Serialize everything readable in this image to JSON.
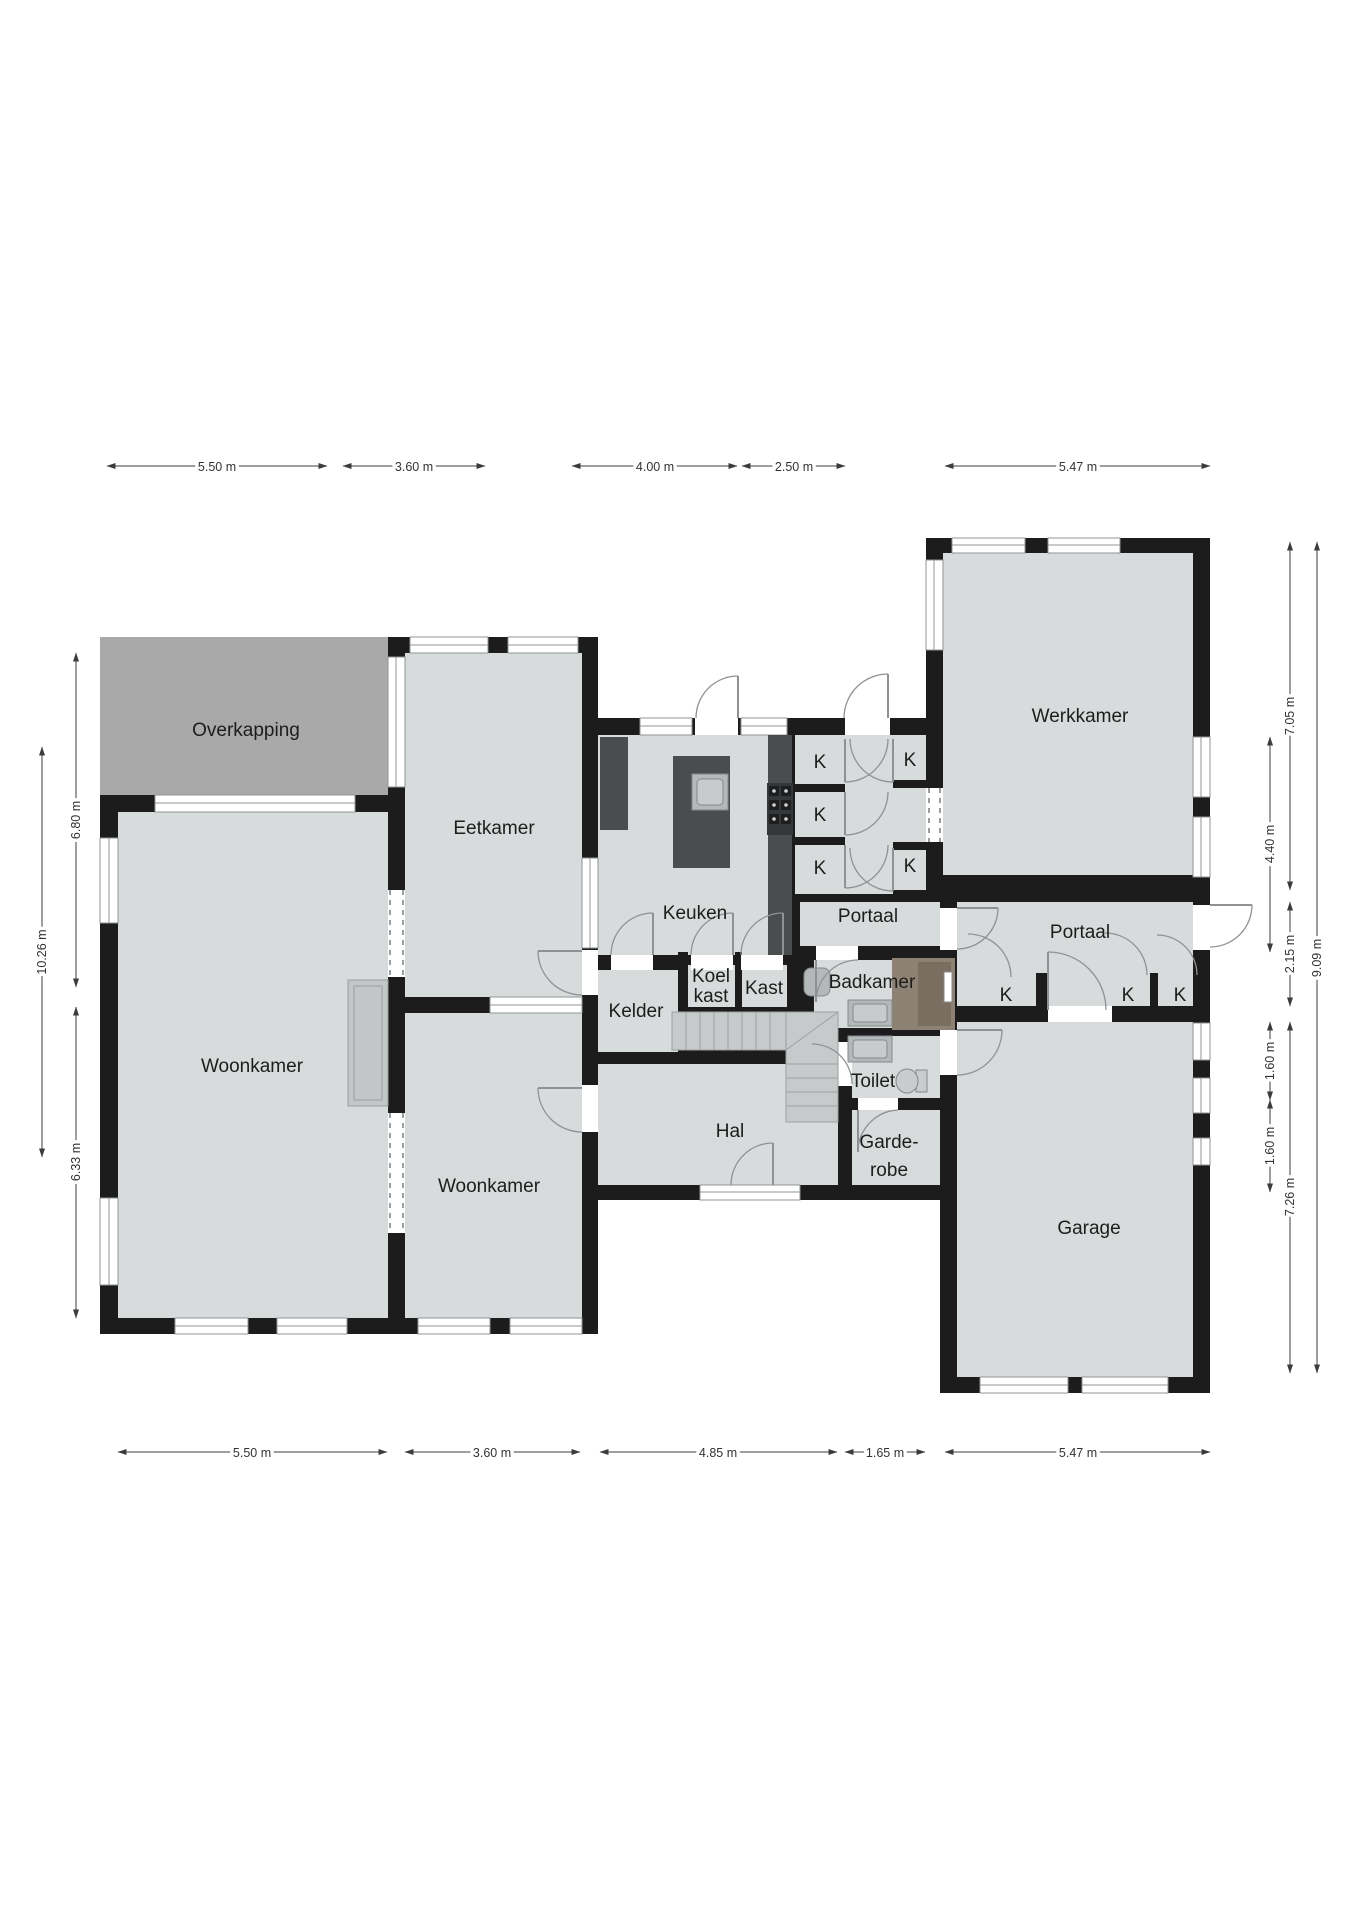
{
  "plan": {
    "type": "floor-plan",
    "language": "Dutch",
    "rooms": {
      "overkapping": {
        "label": "Overkapping"
      },
      "eetkamer": {
        "label": "Eetkamer"
      },
      "keuken": {
        "label": "Keuken"
      },
      "woonkamer_groot": {
        "label": "Woonkamer"
      },
      "woonkamer_klein": {
        "label": "Woonkamer"
      },
      "kelder": {
        "label": "Kelder"
      },
      "koelkast": {
        "line1": "Koel",
        "line2": "kast"
      },
      "kast": {
        "label": "Kast"
      },
      "badkamer": {
        "label": "Badkamer"
      },
      "portaal_noord": {
        "label": "Portaal"
      },
      "portaal_oost": {
        "label": "Portaal"
      },
      "werkkamer": {
        "label": "Werkkamer"
      },
      "hal": {
        "label": "Hal"
      },
      "toilet": {
        "label": "Toilet"
      },
      "garderobe": {
        "line1": "Garde-",
        "line2": "robe"
      },
      "garage": {
        "label": "Garage"
      }
    },
    "closet_label": "K",
    "closet_count": 8,
    "dimensions": {
      "top": [
        "5.50 m",
        "3.60 m",
        "4.00 m",
        "2.50 m",
        "5.47 m"
      ],
      "bottom": [
        "5.50 m",
        "3.60 m",
        "4.85 m",
        "1.65 m",
        "5.47 m"
      ],
      "left_inner": [
        "6.80 m",
        "6.33 m"
      ],
      "left_outer": [
        "10.26 m"
      ],
      "right_inner": [
        "4.40 m",
        "1.60 m",
        "1.60 m"
      ],
      "right_mid": [
        "7.05 m",
        "2.15 m",
        "7.26 m"
      ],
      "right_outer": [
        "9.09 m"
      ]
    },
    "colors": {
      "wall": "#1c1c1c",
      "floor": "#d8dbdb",
      "overkapping": "#a9a9a9",
      "counter": "#4a4d4e",
      "shower": "#8d8173",
      "stairs": "#c7cacb",
      "background": "#ffffff"
    }
  }
}
